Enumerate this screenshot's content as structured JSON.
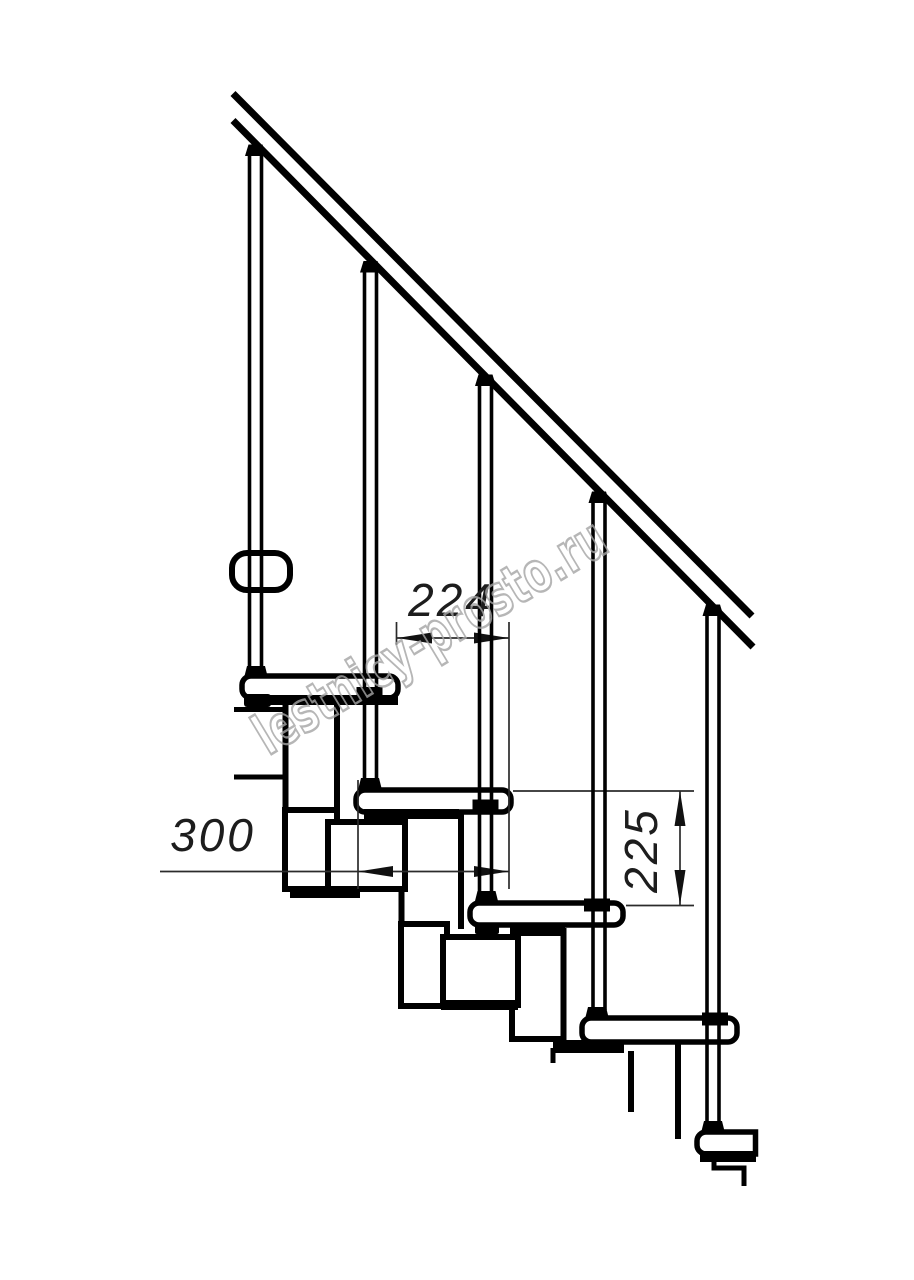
{
  "title": "Modular staircase side-view technical drawing",
  "watermark": {
    "text": "lestnicy-prosto.ru",
    "color": "#a5a5a5"
  },
  "dimensions": {
    "step_run": {
      "label": "224"
    },
    "tread_depth": {
      "label": "300"
    },
    "riser_height": {
      "label": "225"
    }
  },
  "colors": {
    "background": "#ffffff",
    "line": "#000000",
    "dim_line": "#2b2b2b"
  },
  "drawing": {
    "visible_tread_count": 5,
    "baluster_count": 5,
    "element_names": [
      "handrail",
      "balusters",
      "treads",
      "modular-stringer",
      "floor-slab",
      "dimension-lines"
    ]
  }
}
